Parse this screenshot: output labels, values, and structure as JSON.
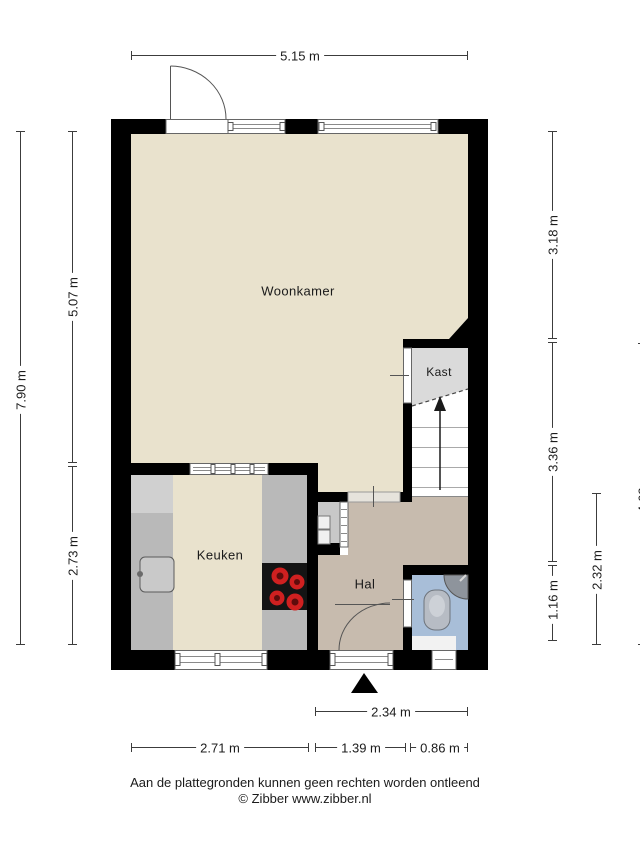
{
  "plan": {
    "title": "Floor plan (begane grond)",
    "rooms": {
      "woonkamer": {
        "label": "Woonkamer"
      },
      "kast": {
        "label": "Kast"
      },
      "keuken": {
        "label": "Keuken"
      },
      "hal": {
        "label": "Hal"
      }
    },
    "dims": {
      "top_width": {
        "label": "5.15 m"
      },
      "left_total": {
        "label": "7.90 m"
      },
      "left_upper": {
        "label": "5.07 m"
      },
      "left_lower": {
        "label": "2.73 m"
      },
      "right_upper": {
        "label": "3.18 m"
      },
      "right_middle": {
        "label": "3.36 m"
      },
      "right_lower": {
        "label": "1.16 m"
      },
      "right_hall": {
        "label": "2.32 m"
      },
      "right_lower_total": {
        "label": "4.62 m"
      },
      "bottom_hall_width": {
        "label": "2.34 m"
      },
      "bottom_kitchen": {
        "label": "2.71 m"
      },
      "bottom_door": {
        "label": "1.39 m"
      },
      "bottom_toilet": {
        "label": "0.86 m"
      }
    },
    "footer": {
      "disclaimer": "Aan de plattegronden kunnen geen rechten worden ontleend",
      "credit": "© Zibber www.zibber.nl"
    },
    "colors": {
      "wall": "#000000",
      "floor_main": "#e9e2cd",
      "floor_hall": "#c7bbae",
      "floor_toilet": "#a8bed8",
      "floor_closet": "#dadada",
      "counter_grey": "#b9b9b9",
      "burner_red": "#cf2020",
      "dimension_line": "#3c3c3c"
    }
  }
}
